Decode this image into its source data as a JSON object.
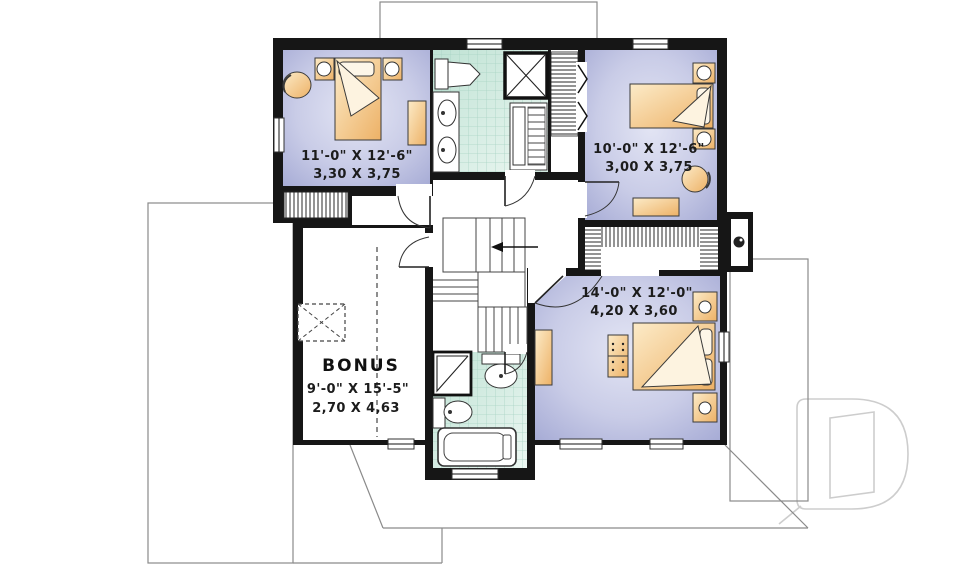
{
  "plan": {
    "rooms": {
      "bedroom1": {
        "imperial": "11'-0\" X 12'-6\"",
        "metric": "3,30 X 3,75"
      },
      "bedroom2": {
        "imperial": "10'-0\" X 12'-6\"",
        "metric": "3,00 X 3,75"
      },
      "bedroom3": {
        "imperial": "14'-0\" X 12'-0\"",
        "metric": "4,20 X 3,60"
      },
      "bonus": {
        "name": "BONUS",
        "imperial": "9'-0\" X 15'-5\"",
        "metric": "2,70 X 4,63"
      }
    },
    "watermark_letter": "D",
    "colors": {
      "wall": "#161616",
      "room_fill_dark": "#a6abd5",
      "room_fill_light": "#e3e5f4",
      "tile_dark": "#bfe2d4",
      "tile_light": "#ecf7f2",
      "tile_grid": "#a9d4c4",
      "furniture_light": "#fcebc8",
      "furniture_dark": "#edb166",
      "roofline": "#8a8a8a",
      "watermark": "#cdcdcd",
      "text": "#1c1c1c"
    }
  }
}
